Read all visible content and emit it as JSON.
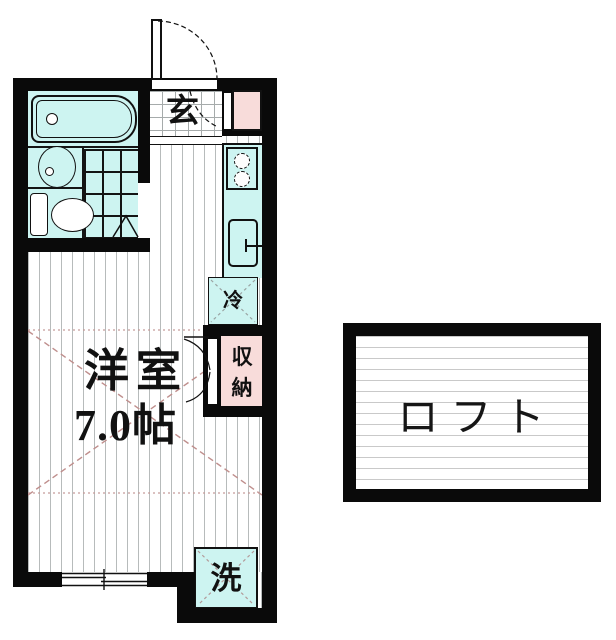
{
  "floor_plan": {
    "main_unit": {
      "entrance_label": "玄",
      "room_name": "洋室",
      "room_size": "7.0帖",
      "refrigerator_label": "冷",
      "storage_label": "収納",
      "washing_machine_label": "洗"
    },
    "loft": {
      "label": "ロフト"
    },
    "colors": {
      "wall_black": "#0a0a0a",
      "fixture_cyan": "#cdf4f1",
      "storage_pink": "#f8dcda",
      "dimension_red": "#bf8e8c",
      "floor_stripe_gray": "#b7bbbb"
    }
  }
}
